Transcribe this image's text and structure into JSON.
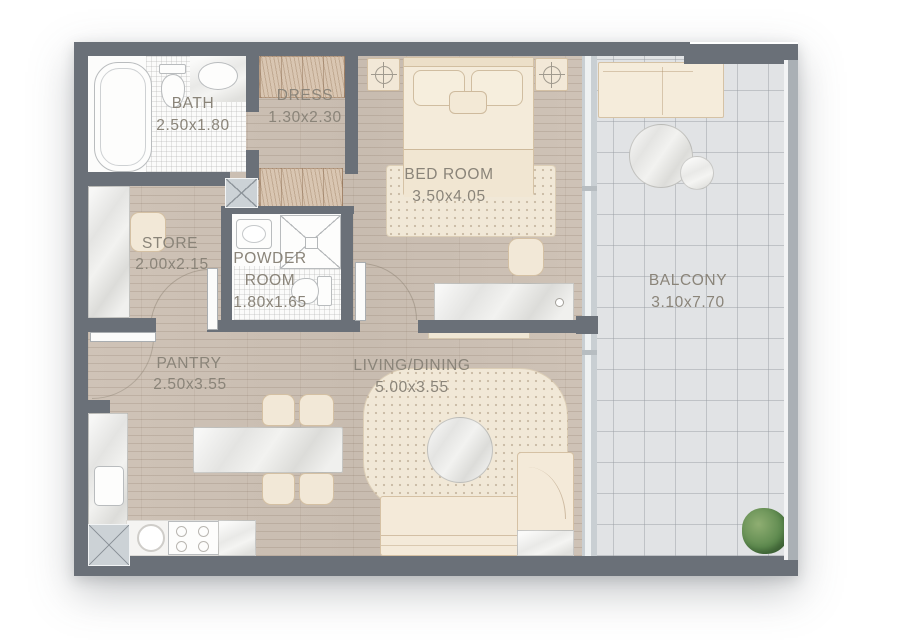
{
  "type": "apartment-floor-plan",
  "rooms": {
    "bath": {
      "label": "BATH",
      "dimensions": "2.50x1.80"
    },
    "dress": {
      "label": "DRESS",
      "dimensions": "1.30x2.30"
    },
    "bedroom": {
      "label": "BED ROOM",
      "dimensions": "3.50x4.05"
    },
    "balcony": {
      "label": "BALCONY",
      "dimensions": "3.10x7.70"
    },
    "store": {
      "label": "STORE",
      "dimensions": "2.00x2.15"
    },
    "powder_room": {
      "label_line1": "POWDER",
      "label_line2": "ROOM",
      "dimensions": "1.80x1.65"
    },
    "pantry": {
      "label": "PANTRY",
      "dimensions": "2.50x3.55"
    },
    "living_dining": {
      "label": "LIVING/DINING",
      "dimensions": "5.00x3.55"
    }
  },
  "colors": {
    "wall": "#6a7078",
    "wood_floor": "#ccc0b4",
    "balcony_tile": "#e1e3e5",
    "furniture_cream": "#f2e8d7",
    "label_text": "#8a8479",
    "plant_green": "#5e8a4f"
  }
}
